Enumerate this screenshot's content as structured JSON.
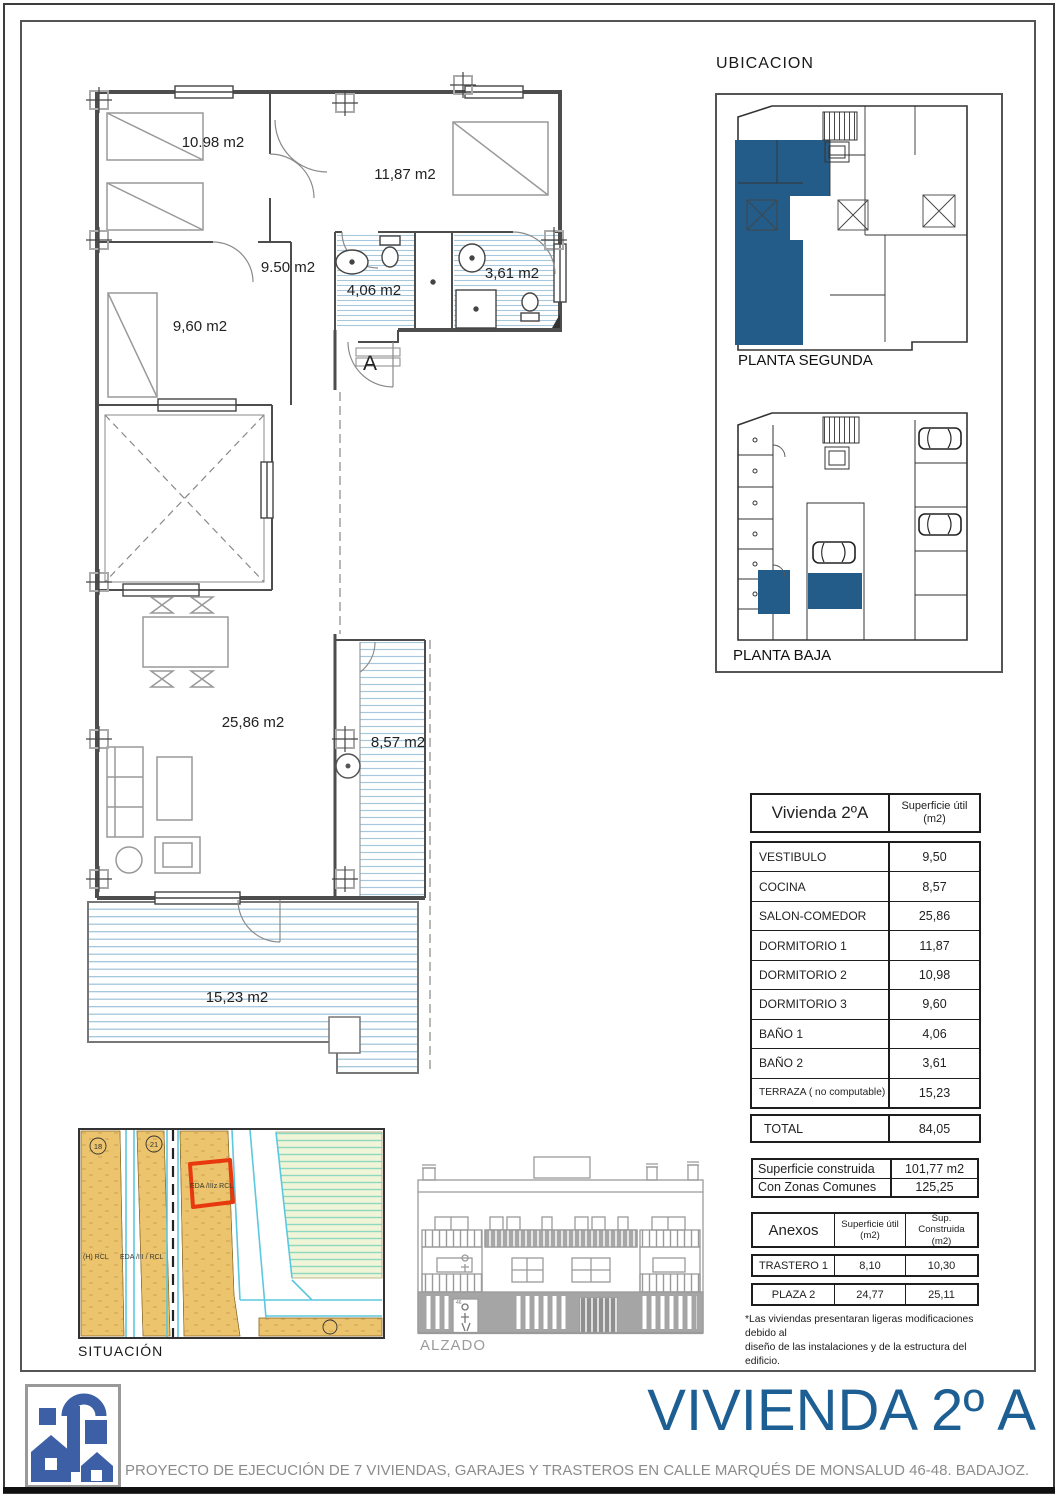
{
  "page": {
    "title": "VIVIENDA 2º A",
    "footer_text": "PROYECTO DE EJECUCIÓN DE 7 VIVIENDAS, GARAJES Y TRASTEROS EN CALLE MARQUÉS DE MONSALUD 46-48. BADAJOZ.",
    "accent_blue": "#1e5f93",
    "highlight_blue": "#235c88",
    "hatch_blue": "#a7c7dd"
  },
  "floor_plan": {
    "rooms": {
      "dormitorio2": "10.98 m2",
      "dormitorio1": "11,87 m2",
      "vestibulo": "9.50 m2",
      "bano1": "4,06 m2",
      "bano2": "3,61 m2",
      "dormitorio3": "9,60 m2",
      "salon_comedor": "25,86 m2",
      "cocina": "8,57 m2",
      "terraza": "15,23 m2"
    },
    "section_mark": "A"
  },
  "ubicacion": {
    "title": "UBICACION",
    "planta_segunda": "PLANTA SEGUNDA",
    "planta_baja": "PLANTA BAJA"
  },
  "situacion": {
    "label": "SITUACIÓN",
    "zone_labels": [
      "EDA /IIIz RCL",
      "EDA /III / RCL",
      "(H) RCL"
    ],
    "parcel_numbers": [
      "18",
      "21"
    ]
  },
  "alzado": {
    "label": "ALZADO",
    "portal_number": "46"
  },
  "tables": {
    "superficie": {
      "title": "Vivienda 2ºA",
      "unit_header": "Superficie útil (m2)",
      "rows": [
        {
          "label": "VESTIBULO",
          "value": "9,50"
        },
        {
          "label": "COCINA",
          "value": "8,57"
        },
        {
          "label": "SALON-COMEDOR",
          "value": "25,86"
        },
        {
          "label": "DORMITORIO 1",
          "value": "11,87"
        },
        {
          "label": "DORMITORIO 2",
          "value": "10,98"
        },
        {
          "label": "DORMITORIO 3",
          "value": "9,60"
        },
        {
          "label": "BAÑO 1",
          "value": "4,06"
        },
        {
          "label": "BAÑO 2",
          "value": "3,61"
        },
        {
          "label": "TERRAZA ( no computable)",
          "value": "15,23"
        }
      ],
      "total": {
        "label": "TOTAL",
        "value": "84,05"
      }
    },
    "construida": {
      "rows": [
        {
          "label": "Superficie construida",
          "value": "101,77 m2"
        },
        {
          "label": "Con Zonas Comunes",
          "value": "125,25"
        }
      ]
    },
    "anexos": {
      "title": "Anexos",
      "col_util": "Superficie útil (m2)",
      "col_construida": "Sup. Construida (m2)",
      "rows": [
        {
          "label": "TRASTERO 1",
          "util": "8,10",
          "construida": "10,30"
        },
        {
          "label": "PLAZA 2",
          "util": "24,77",
          "construida": "25,11"
        }
      ]
    },
    "footnote_lines": [
      "*Las viviendas presentaran ligeras modificaciones debido al",
      "diseño de las instalaciones y de la estructura del edificio."
    ]
  }
}
